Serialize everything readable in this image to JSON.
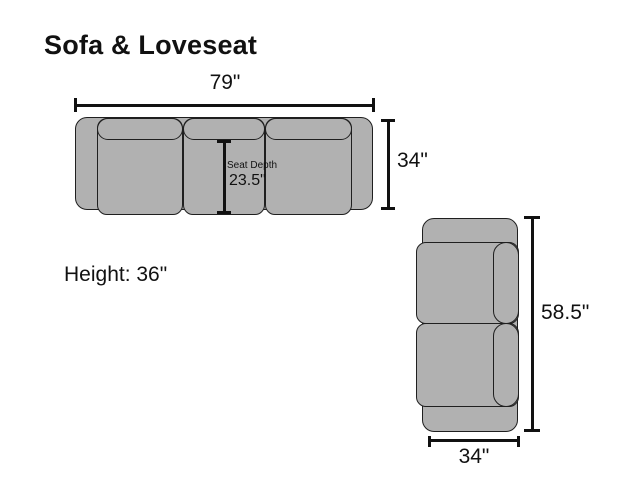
{
  "title": "Sofa & Loveseat",
  "height_note": "Height: 36\"",
  "sofa": {
    "width_label": "79\"",
    "depth_label": "34\"",
    "seat_depth_label": "Seat Depth",
    "seat_depth_value": "23.5\""
  },
  "loveseat": {
    "length_label": "58.5\"",
    "width_label": "34\""
  },
  "colors": {
    "background": "#ffffff",
    "upholstery-fill": "#b1b1b1",
    "outline": "#1f1f1f",
    "dimension": "#111111",
    "text": "#111111"
  }
}
